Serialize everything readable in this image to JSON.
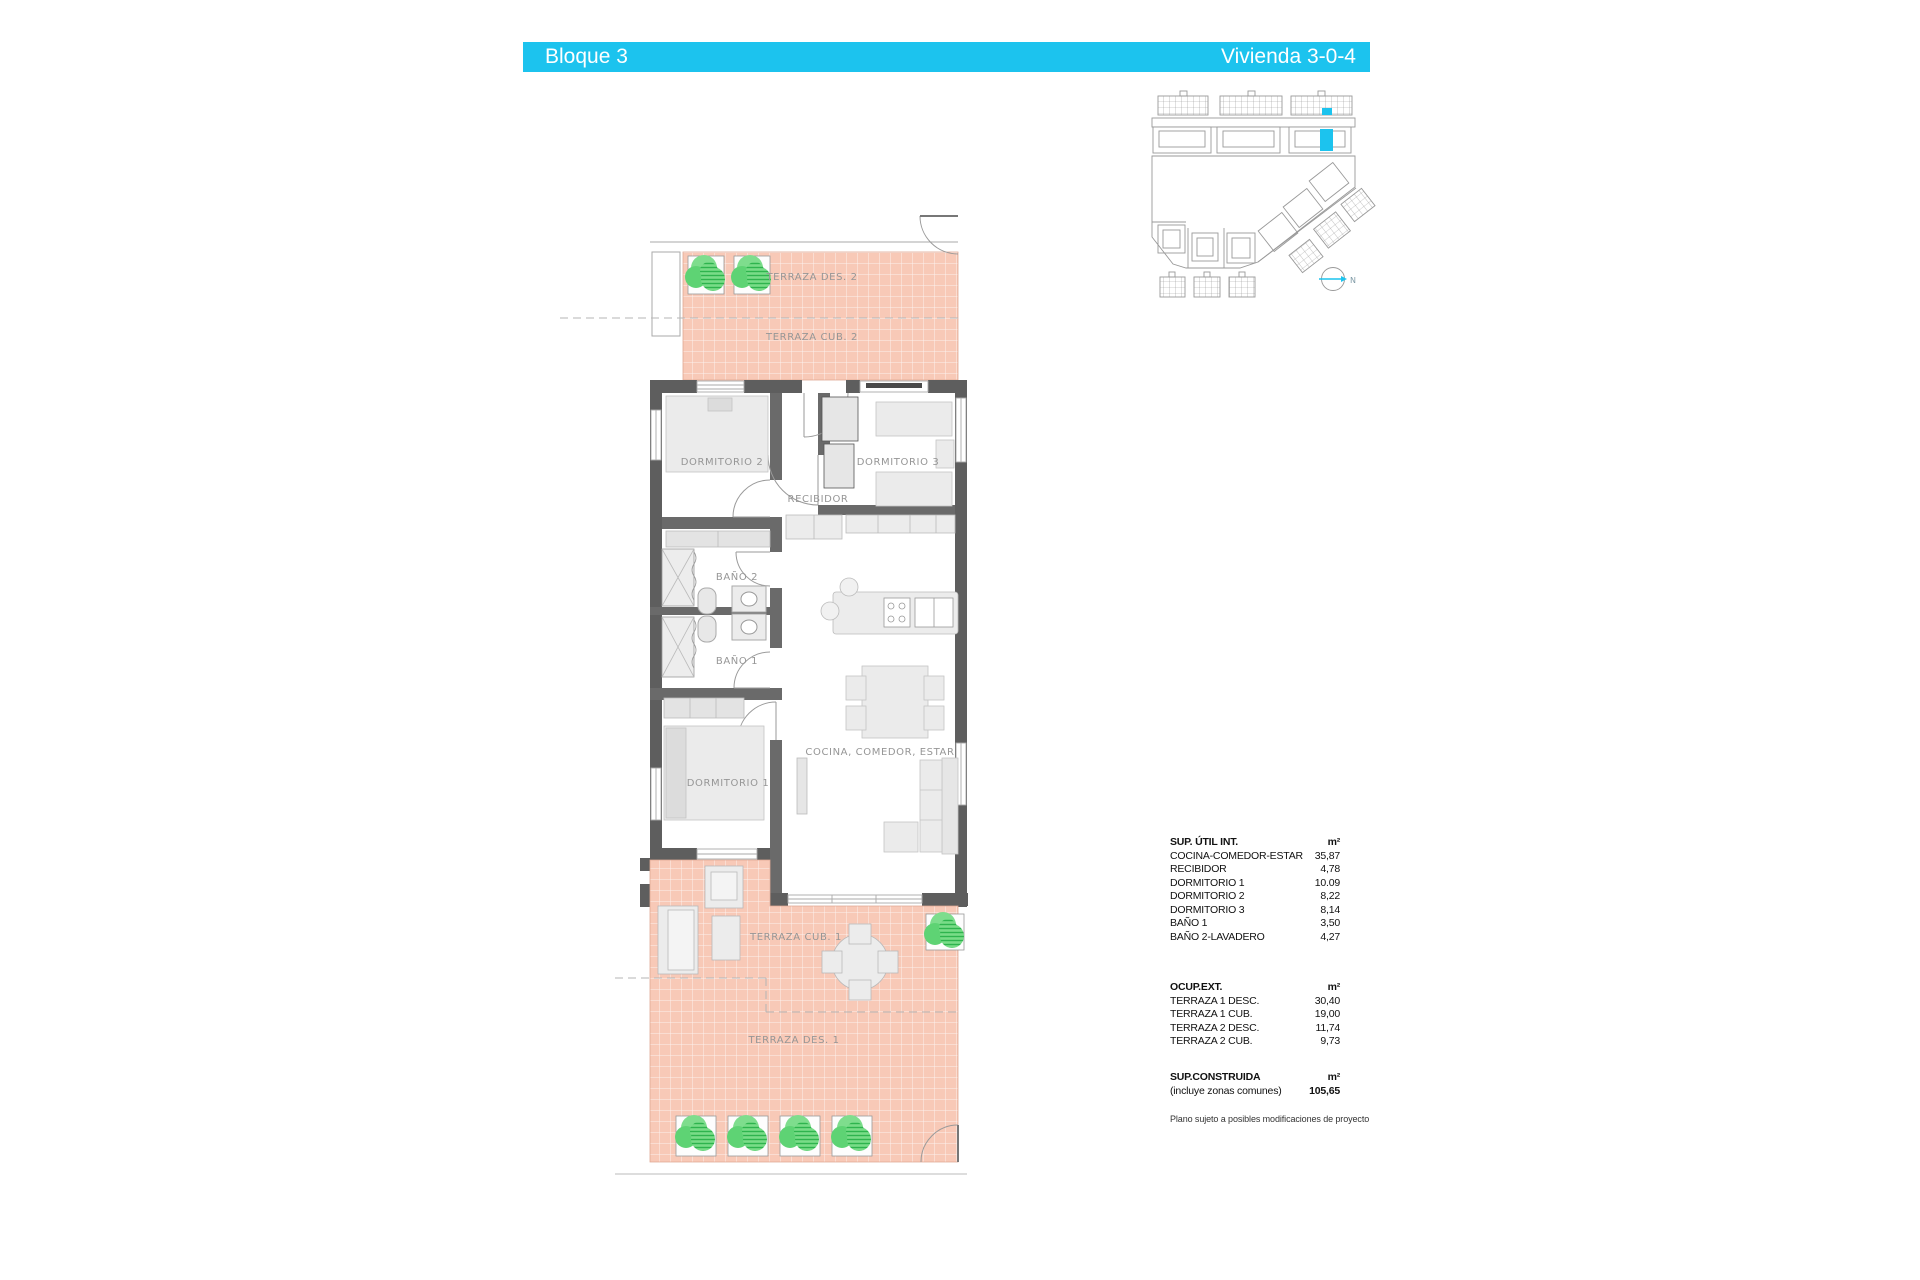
{
  "header": {
    "left": "Bloque 3",
    "right": "Vivienda 3-0-4"
  },
  "colors": {
    "accent": "#1cc3ee",
    "terrace_fill": "#f8c9b7",
    "wall": "#5e5e5e",
    "plant_green": "#5ed374",
    "label_gray": "#969696"
  },
  "floorplan": {
    "labels": {
      "terraza_des_2": "TERRAZA DES. 2",
      "terraza_cub_2": "TERRAZA CUB. 2",
      "dormitorio_2": "DORMITORIO 2",
      "dormitorio_3": "DORMITORIO 3",
      "recibidor": "RECIBIDOR",
      "bano_2": "BAÑO 2",
      "bano_1": "BAÑO 1",
      "dormitorio_1": "DORMITORIO 1",
      "cocina_comedor_estar": "COCINA, COMEDOR, ESTAR",
      "terraza_cub_1": "TERRAZA CUB. 1",
      "terraza_des_1": "TERRAZA DES. 1"
    }
  },
  "siteplan": {
    "north_label": "N"
  },
  "tables": {
    "util": {
      "title": "SUP. ÚTIL INT.",
      "unit": "m²",
      "rows": [
        {
          "label": "COCINA-COMEDOR-ESTAR",
          "value": "35,87"
        },
        {
          "label": "RECIBIDOR",
          "value": "4,78"
        },
        {
          "label": "DORMITORIO 1",
          "value": "10.09"
        },
        {
          "label": "DORMITORIO 2",
          "value": "8,22"
        },
        {
          "label": "DORMITORIO 3",
          "value": "8,14"
        },
        {
          "label": "BAÑO 1",
          "value": "3,50"
        },
        {
          "label": "BAÑO 2-LAVADERO",
          "value": "4,27"
        }
      ]
    },
    "ext": {
      "title": "OCUP.EXT.",
      "unit": "m²",
      "rows": [
        {
          "label": "TERRAZA 1 DESC.",
          "value": "30,40"
        },
        {
          "label": "TERRAZA 1 CUB.",
          "value": "19,00"
        },
        {
          "label": "TERRAZA 2 DESC.",
          "value": "11,74"
        },
        {
          "label": "TERRAZA 2 CUB.",
          "value": "9,73"
        }
      ]
    },
    "constructed": {
      "title": "SUP.CONSTRUIDA",
      "unit": "m²",
      "subtitle": "(incluye zonas comunes)",
      "value": "105,65"
    },
    "footnote": "Plano sujeto a posibles modificaciones de proyecto"
  }
}
